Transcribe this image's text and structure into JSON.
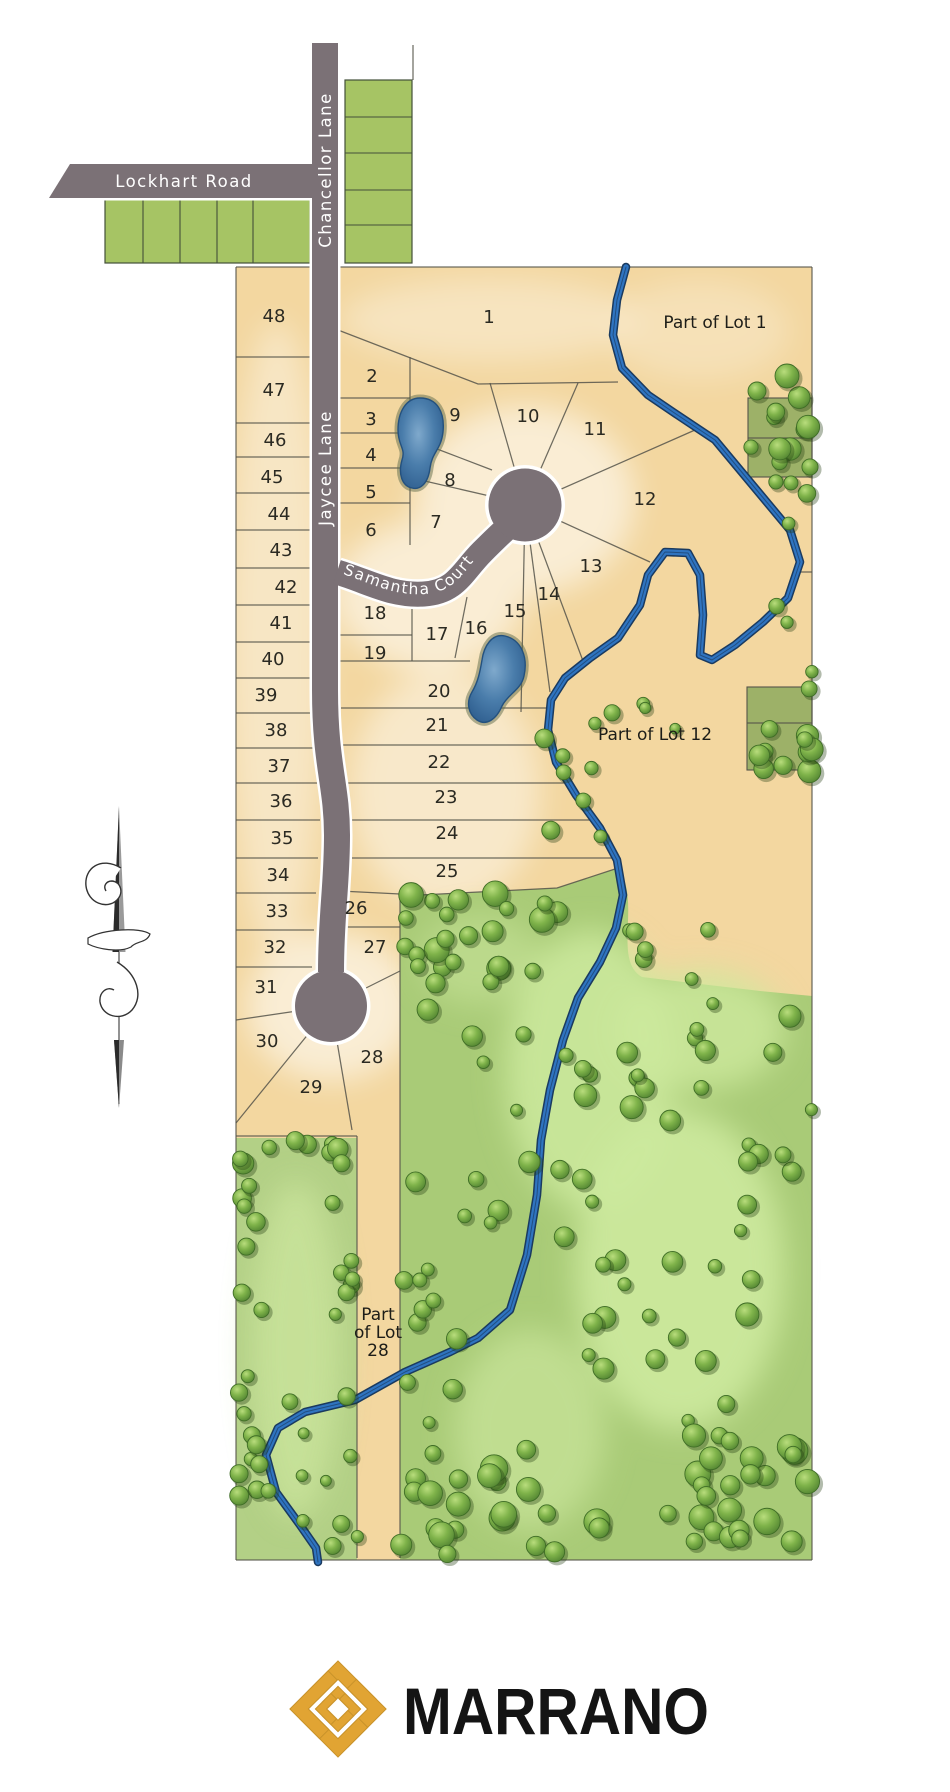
{
  "map": {
    "roads": {
      "lockhart": "Lockhart Road",
      "chancellor": "Chancellor Lane",
      "jaycee": "Jaycee Lane",
      "samantha": "Samantha Court"
    },
    "parcels": {
      "part_of_lot_1": "Part of Lot 1",
      "part_of_lot_12": "Part of Lot 12",
      "part_of_lot_28_line1": "Part",
      "part_of_lot_28_line2": "of Lot",
      "part_of_lot_28_line3": "28"
    },
    "lots": [
      "1",
      "2",
      "3",
      "4",
      "5",
      "6",
      "7",
      "8",
      "9",
      "10",
      "11",
      "12",
      "13",
      "14",
      "15",
      "16",
      "17",
      "18",
      "19",
      "20",
      "21",
      "22",
      "23",
      "24",
      "25",
      "26",
      "27",
      "28",
      "29",
      "30",
      "31",
      "32",
      "33",
      "34",
      "35",
      "36",
      "37",
      "38",
      "39",
      "40",
      "41",
      "42",
      "43",
      "44",
      "45",
      "46",
      "47",
      "48"
    ],
    "colors": {
      "road_gray": "#7b7176",
      "lot_tan": "#f3d7a0",
      "creek_blue": "#2f74c0",
      "forest_green": "#a9cb77",
      "tree_green": "#6fa83f",
      "pond_blue": "#3f6f9f",
      "logo_gold": "#e1a433"
    }
  },
  "branding": {
    "name": "MARRANO"
  }
}
